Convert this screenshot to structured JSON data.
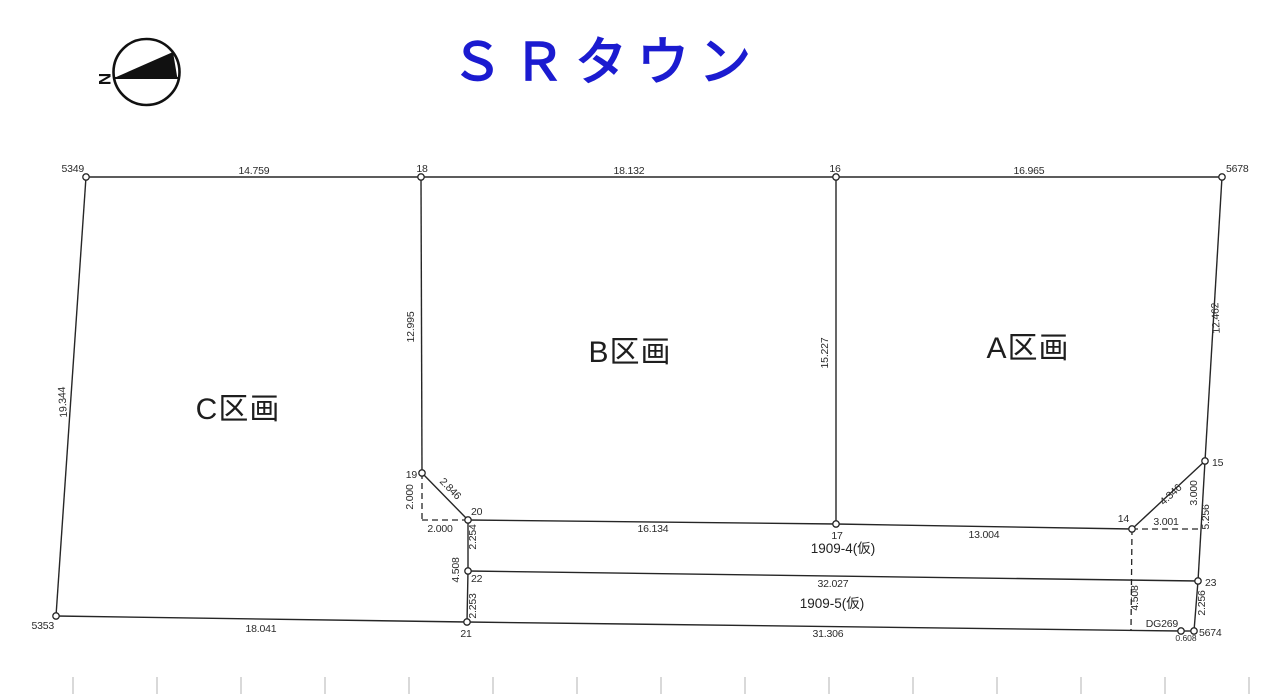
{
  "title": "ＳＲタウン",
  "colors": {
    "title": "#1b1bd0",
    "line": "#262626"
  },
  "compass": {
    "north": "N"
  },
  "parcels": {
    "a": "A区画",
    "b": "B区画",
    "c": "C区画"
  },
  "lots": {
    "lot4": "1909-4(仮)",
    "lot5": "1909-5(仮)"
  },
  "points": {
    "p5349": "5349",
    "p18": "18",
    "p16": "16",
    "p5678": "5678",
    "p19": "19",
    "p20": "20",
    "p22": "22",
    "p21": "21",
    "p5353": "5353",
    "p17": "17",
    "p14": "14",
    "p15": "15",
    "p23": "23",
    "p5674": "5674",
    "pdg269": "DG269"
  },
  "measurements": {
    "m5349_18": "14.759",
    "m18_16": "18.132",
    "m16_5678": "16.965",
    "m5349_5353": "19.344",
    "m18_19": "12.995",
    "m16_17": "15.227",
    "m5678_15": "12.462",
    "m19_20": "2.846",
    "m19_v": "2.000",
    "m19_h": "2.000",
    "m20_22": "2.254",
    "m20_21": "4.508",
    "m22_21": "2.253",
    "m20_17": "16.134",
    "m17_14": "13.004",
    "m22_23": "32.027",
    "m5353_21": "18.041",
    "m21_5674": "31.306",
    "m14_15": "4.346",
    "m14_h": "3.001",
    "m15_v": "3.000",
    "m15_23": "5.256",
    "m23_5674": "2.256",
    "m14_down": "4.508",
    "mdg269_5674": "0.608"
  }
}
